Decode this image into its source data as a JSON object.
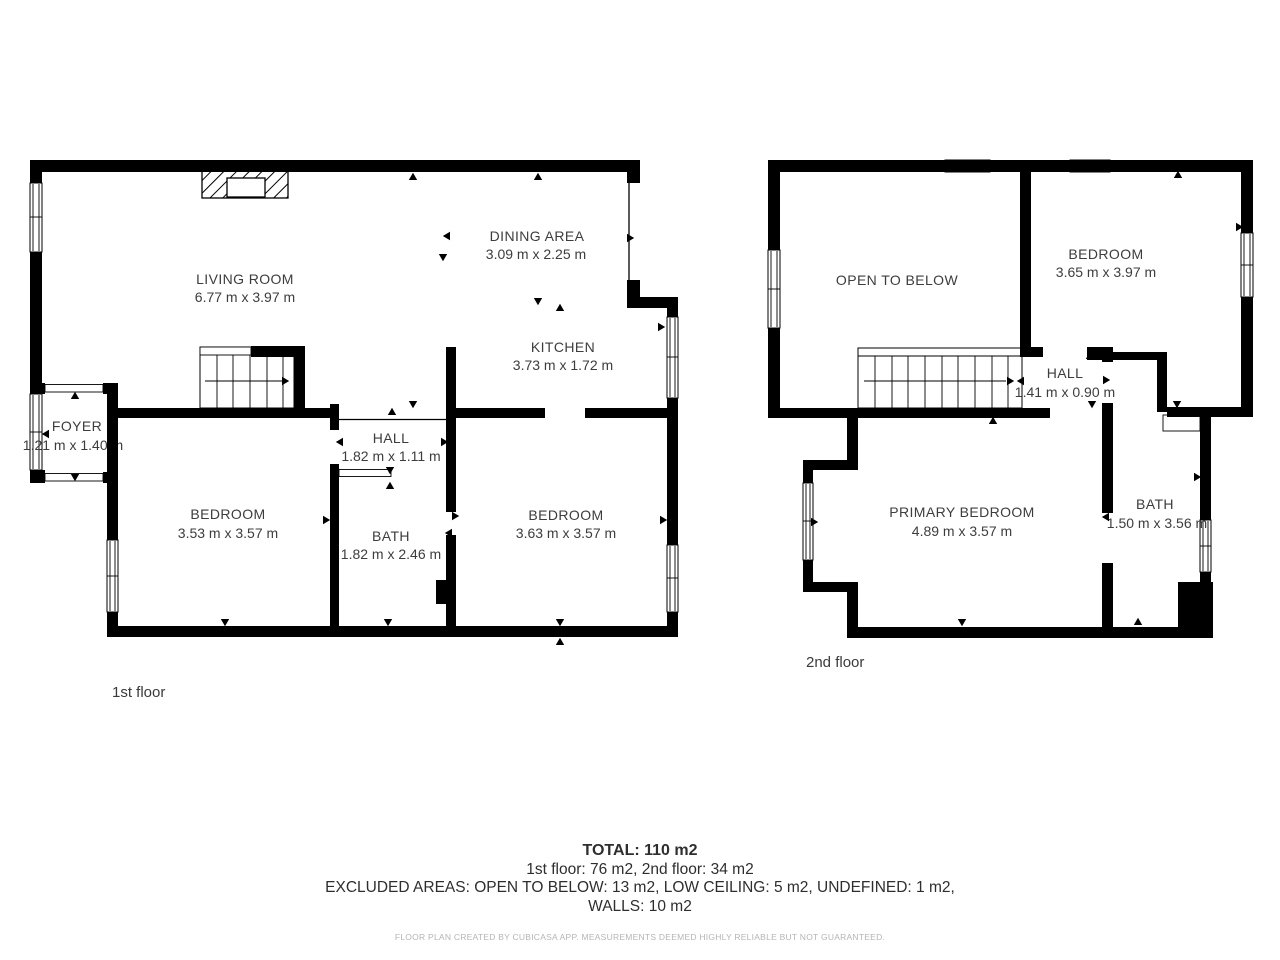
{
  "floors": {
    "first": {
      "label": "1st floor",
      "rooms": {
        "living_room": {
          "name": "LIVING ROOM",
          "dims": "6.77 m x 3.97 m"
        },
        "dining_area": {
          "name": "DINING AREA",
          "dims": "3.09 m x 2.25 m"
        },
        "kitchen": {
          "name": "KITCHEN",
          "dims": "3.73 m x 1.72 m"
        },
        "foyer": {
          "name": "FOYER",
          "dims": "1.21 m x 1.40 m"
        },
        "hall": {
          "name": "HALL",
          "dims": "1.82 m x 1.11 m"
        },
        "bedroom_left": {
          "name": "BEDROOM",
          "dims": "3.53 m x 3.57 m"
        },
        "bath": {
          "name": "BATH",
          "dims": "1.82 m x 2.46 m"
        },
        "bedroom_right": {
          "name": "BEDROOM",
          "dims": "3.63 m x 3.57 m"
        }
      }
    },
    "second": {
      "label": "2nd floor",
      "rooms": {
        "open_to_below": {
          "name": "OPEN TO BELOW"
        },
        "bedroom": {
          "name": "BEDROOM",
          "dims": "3.65 m x 3.97 m"
        },
        "hall": {
          "name": "HALL",
          "dims": "1.41 m x 0.90 m"
        },
        "primary_bedroom": {
          "name": "PRIMARY BEDROOM",
          "dims": "4.89 m x 3.57 m"
        },
        "bath": {
          "name": "BATH",
          "dims": "1.50 m x 3.56 m"
        }
      }
    }
  },
  "summary": {
    "total": "TOTAL: 110 m2",
    "floors_line": "1st floor: 76 m2, 2nd floor: 34 m2",
    "excluded_line1": "EXCLUDED AREAS: OPEN TO BELOW: 13 m2, LOW CEILING: 5 m2, UNDEFINED: 1 m2,",
    "excluded_line2": "WALLS: 10 m2"
  },
  "footer": {
    "disclaimer": "FLOOR PLAN CREATED BY CUBICASA APP. MEASUREMENTS DEEMED HIGHLY RELIABLE BUT NOT GUARANTEED."
  },
  "colors": {
    "wall": "#000000",
    "room_text": "#3d3d3d",
    "footer_text": "#b5b5b5",
    "background": "#ffffff"
  }
}
